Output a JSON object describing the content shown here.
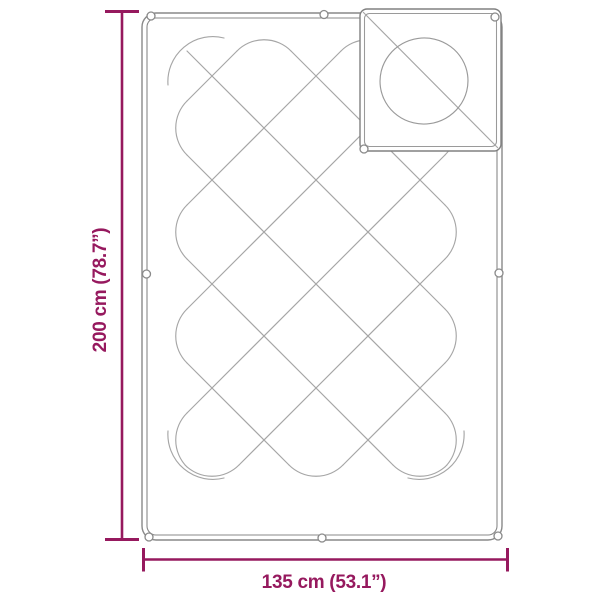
{
  "diagram": {
    "type": "product-dimension-diagram",
    "subject": "quilted blanket with pillow",
    "dimensions": {
      "height_label": "200 cm (78.7”)",
      "width_label": "135 cm (53.1”)"
    },
    "colors": {
      "accent": "#96195E",
      "outline_gray": "#898989",
      "stitch_gray": "#A6A6A6"
    }
  }
}
